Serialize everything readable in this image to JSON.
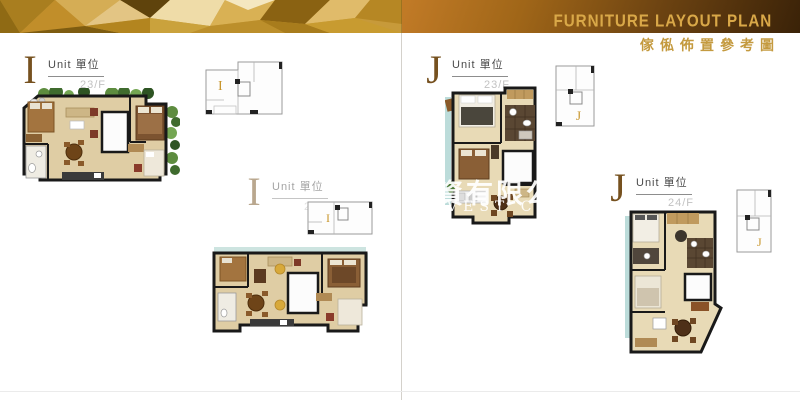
{
  "header": {
    "title_en": "FURNITURE LAYOUT PLAN",
    "title_zh": "傢俬佈置參考圖"
  },
  "units": [
    {
      "id": "I-23",
      "letter": "I",
      "unit_text": "Unit 單位",
      "floor": "23/F",
      "key_letter": "I"
    },
    {
      "id": "I-24",
      "letter": "I",
      "unit_text": "Unit 單位",
      "floor": "24/F",
      "key_letter": "I"
    },
    {
      "id": "J-23",
      "letter": "J",
      "unit_text": "Unit 單位",
      "floor": "23/F",
      "key_letter": "J"
    },
    {
      "id": "J-24",
      "letter": "J",
      "unit_text": "Unit 單位",
      "floor": "24/F",
      "key_letter": "J"
    }
  ],
  "watermark": {
    "line1": "資有限公",
    "line2": "VEST CO"
  },
  "colors": {
    "accent_gold": "#c8962c",
    "banner_orange": "#c27b27",
    "banner_dark": "#3a2208",
    "title_gold": "#d9a848",
    "subtitle_gold": "#c49a3f",
    "unit_letter_brown": "#76511f",
    "floor_text_gray": "#c2c2c2"
  }
}
